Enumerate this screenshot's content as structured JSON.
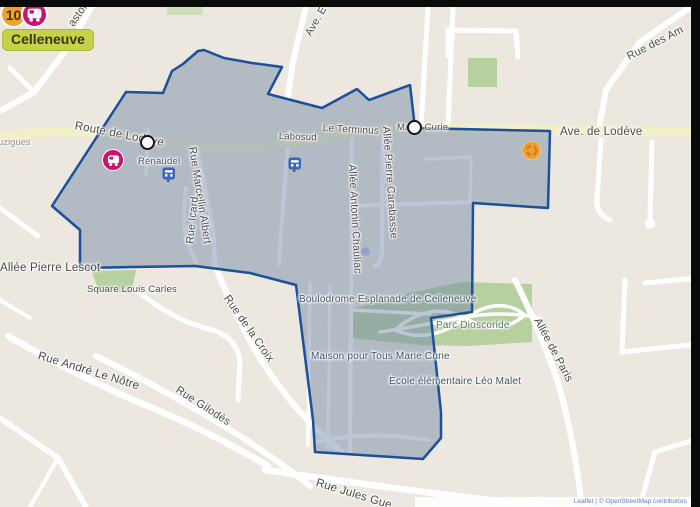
{
  "header": {
    "line_number": "10",
    "area_label": "Celleneuve"
  },
  "map": {
    "labels": [
      {
        "id": "pastor",
        "text": "astor"
      },
      {
        "id": "ave-e",
        "text": "Ave. E"
      },
      {
        "id": "rue-des-am",
        "text": "Rue des Am"
      },
      {
        "id": "luzigues",
        "text": "Luzigues"
      },
      {
        "id": "route-de-lodeve",
        "text": "Route de Lodève"
      },
      {
        "id": "labosud",
        "text": "Labosud"
      },
      {
        "id": "le-terminus",
        "text": "Le Terminus"
      },
      {
        "id": "marie-curie-stop",
        "text": "Marie Curie"
      },
      {
        "id": "ave-de-lodeve",
        "text": "Ave. de Lodève"
      },
      {
        "id": "renaudel",
        "text": "Renaudel"
      },
      {
        "id": "rue-marcellin-albert",
        "text": "Rue Marcellin Albert"
      },
      {
        "id": "rue-icard",
        "text": "Rue Icard"
      },
      {
        "id": "allee-pierre-carabasse",
        "text": "Allée Pierre Carabasse"
      },
      {
        "id": "allee-antonin-chauliac",
        "text": "Allée Antonin Chauliac"
      },
      {
        "id": "allee-pierre-lescot",
        "text": "Allée Pierre Lescot"
      },
      {
        "id": "square-louis-carles",
        "text": "Square Louis Carles"
      },
      {
        "id": "rue-andre-le-notre",
        "text": "Rue André Le Nôtre"
      },
      {
        "id": "rue-de-la-croix",
        "text": "Rue de la Croix"
      },
      {
        "id": "rue-gilodes",
        "text": "Rue Gilodès"
      },
      {
        "id": "boulodrome",
        "text": "Boulodrome Esplanade de Celleneuve"
      },
      {
        "id": "parc-dioscoride",
        "text": "Parc Dioscoride"
      },
      {
        "id": "maison-pour-tous",
        "text": "Maison pour Tous Marie Curie"
      },
      {
        "id": "ecole-leo-malet",
        "text": "École élémentaire Léo Malet"
      },
      {
        "id": "allee-de-paris",
        "text": "Allée de Paris"
      },
      {
        "id": "rue-jules-gue",
        "text": "Rue Jules Gue"
      }
    ],
    "attribution": "Leaflet | © OpenStreetMap contributors",
    "colors": {
      "zone_fill": "#7488a8",
      "zone_border": "#1c4f9c",
      "road_major": "#f2f0c6",
      "park": "#b7d0a0",
      "badge_orange": "#f0a232",
      "badge_magenta": "#cb1172",
      "area_chip_bg": "#c6d348"
    }
  }
}
